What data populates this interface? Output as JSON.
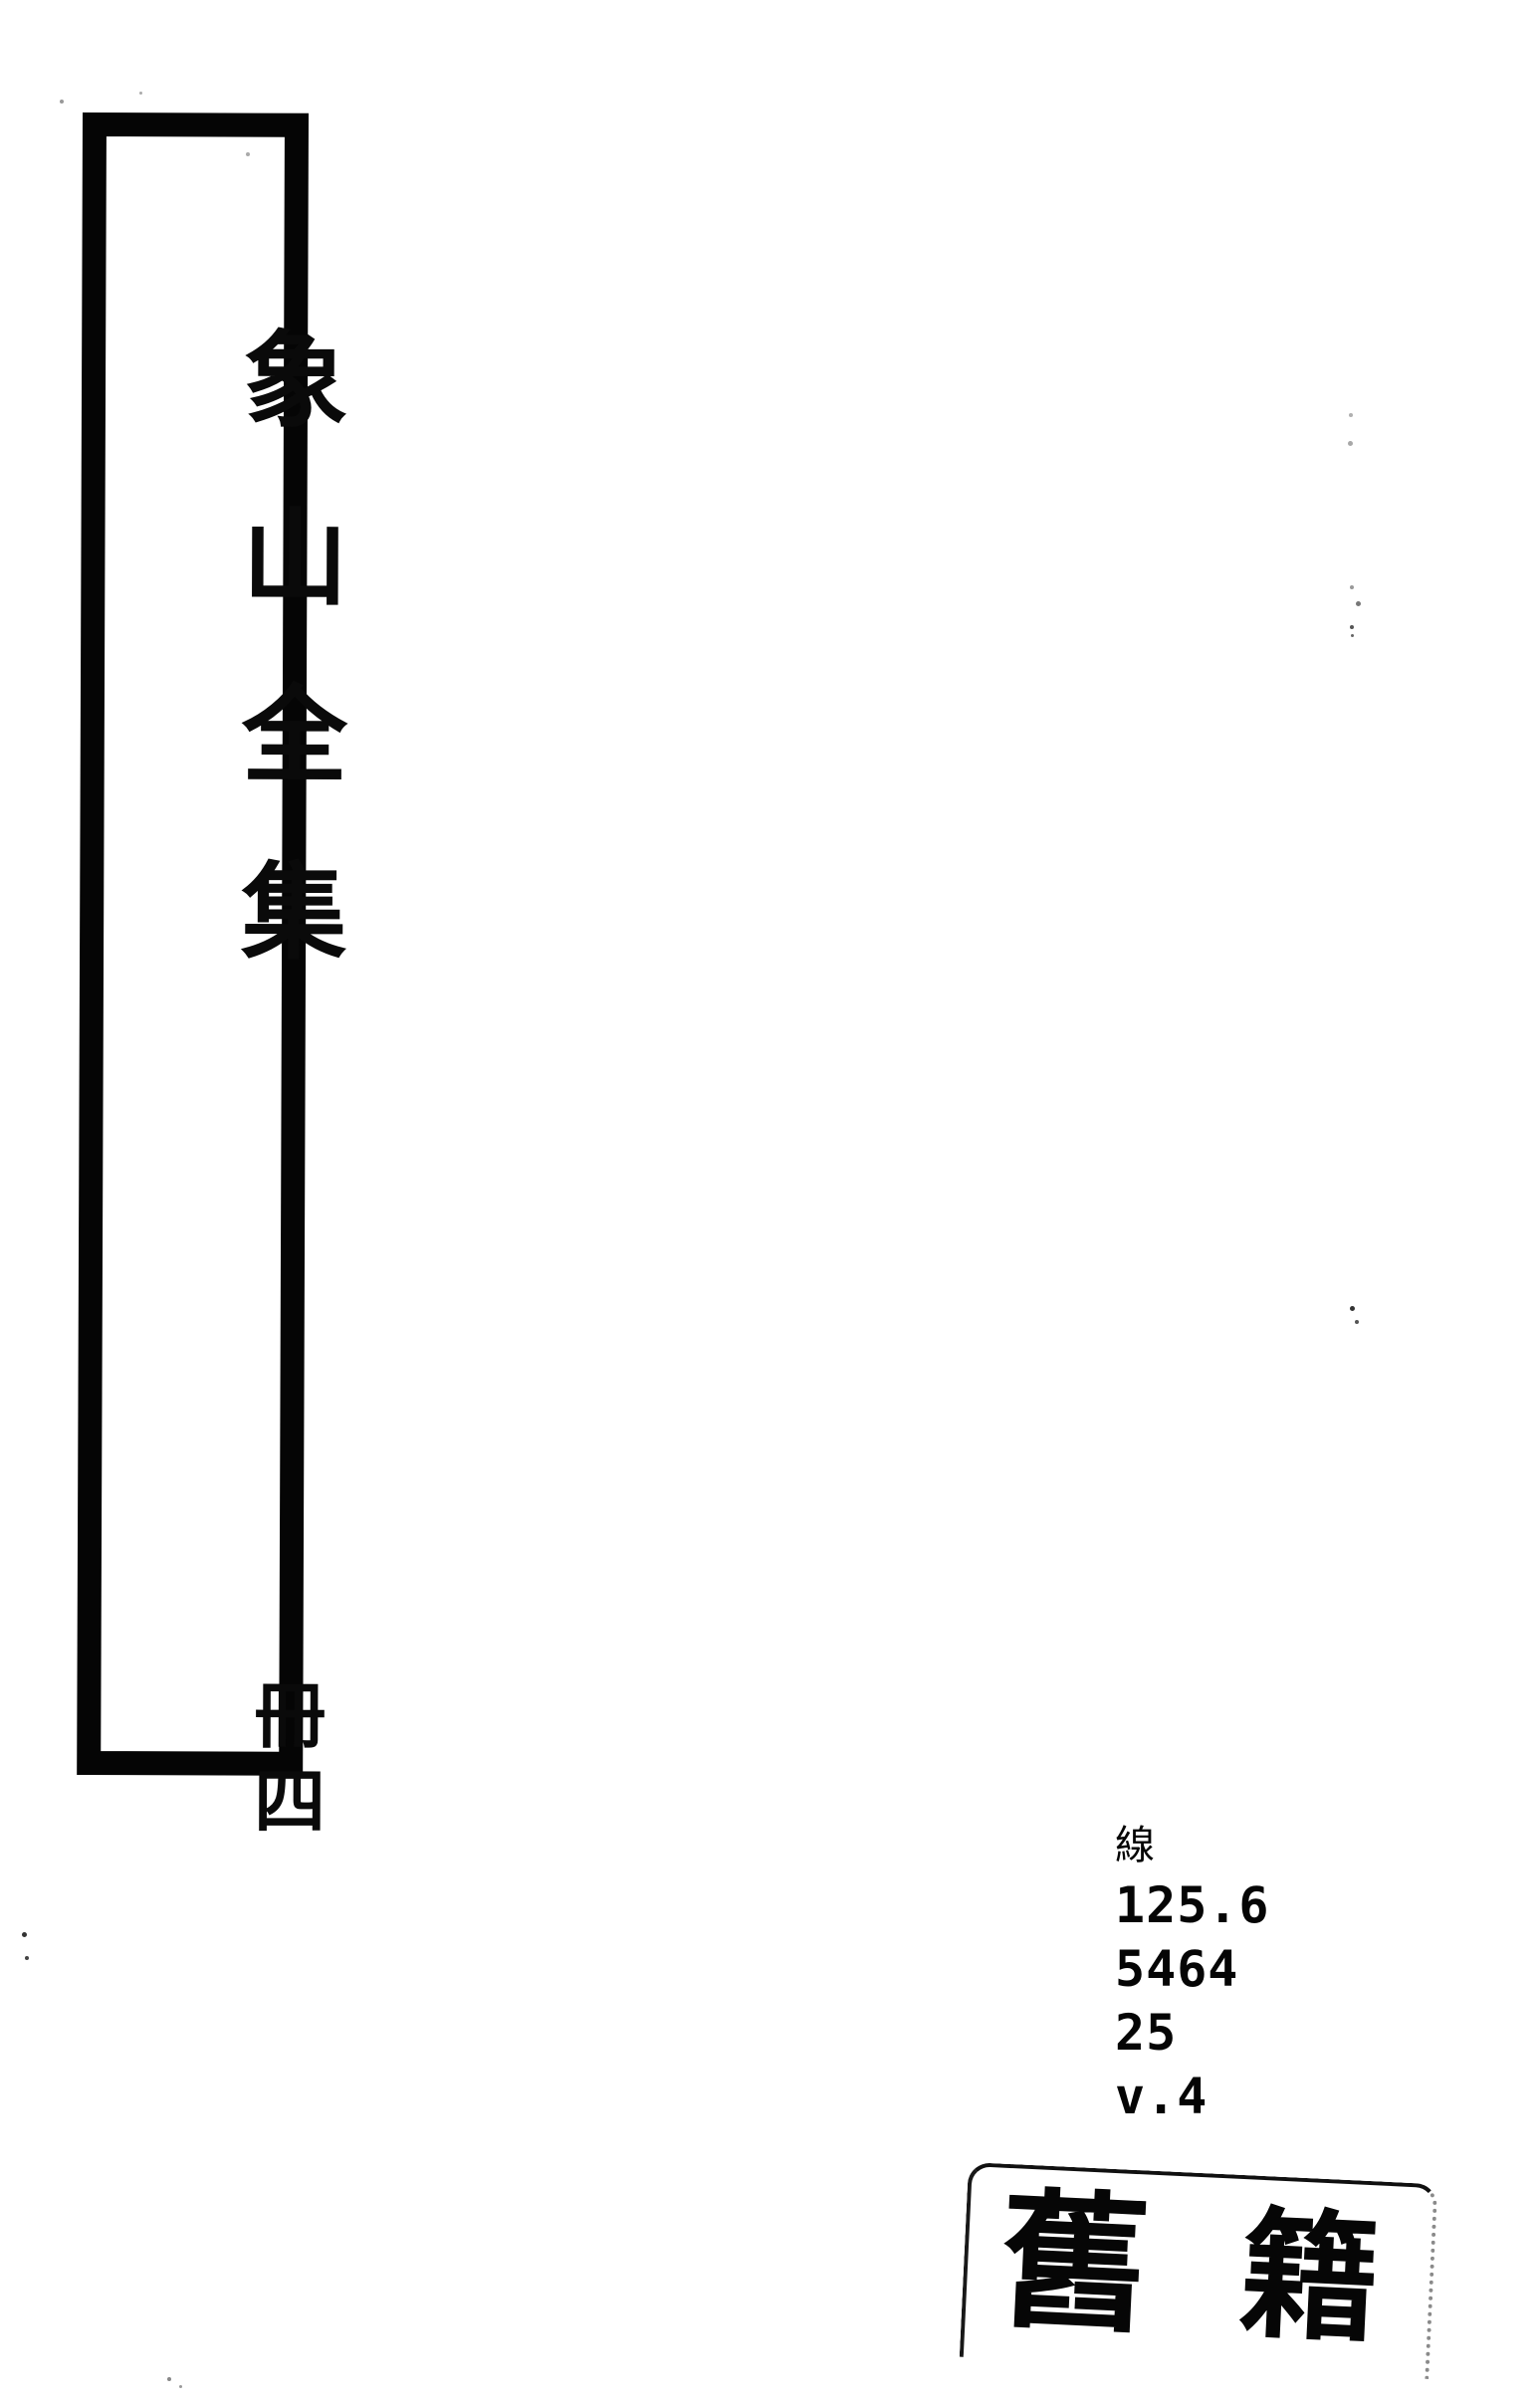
{
  "colors": {
    "paper": "#ffffff",
    "ink": "#050505"
  },
  "spine_label": {
    "title_text": "象山全集",
    "title_chars": [
      "象",
      "山",
      "全",
      "集"
    ],
    "volume_text": "冊四",
    "volume_chars": [
      "冊",
      "四"
    ]
  },
  "call_number": {
    "heading_char": "線",
    "lines": [
      "125.6",
      "5464",
      "25",
      "v.4"
    ]
  },
  "stamp": {
    "text": "舊籍",
    "chars": [
      "舊",
      "籍"
    ]
  }
}
